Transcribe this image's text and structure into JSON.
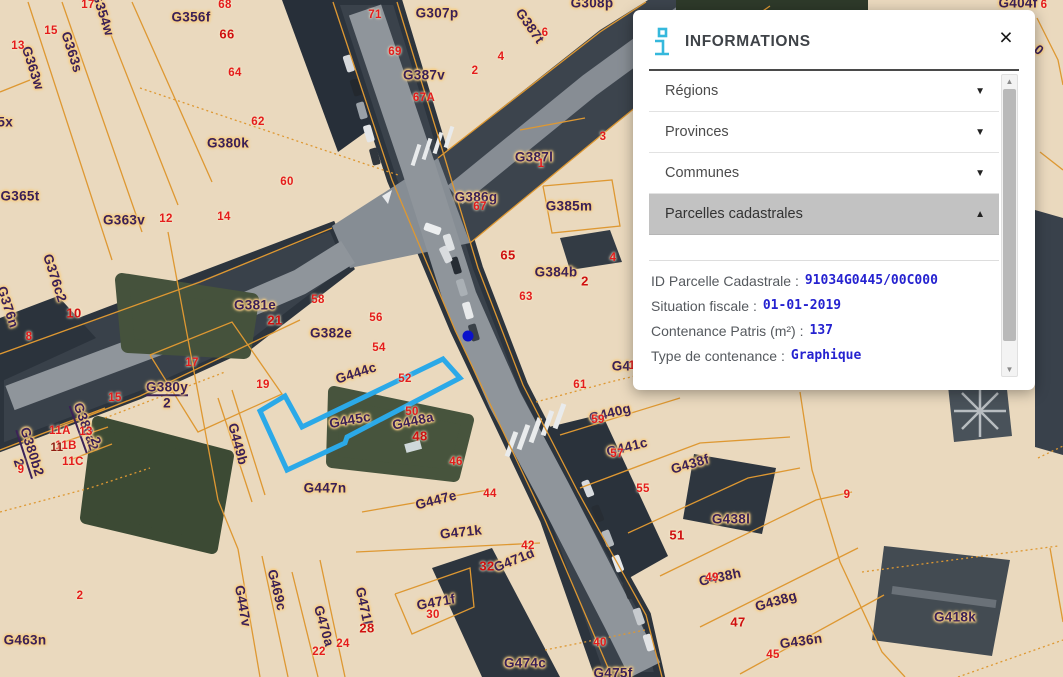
{
  "panel": {
    "title": "INFORMATIONS",
    "close_label": "×",
    "accordion": [
      {
        "label": "Régions",
        "state": "collapsed",
        "chevron": "▼"
      },
      {
        "label": "Provinces",
        "state": "collapsed",
        "chevron": "▼"
      },
      {
        "label": "Communes",
        "state": "collapsed",
        "chevron": "▼"
      },
      {
        "label": "Parcelles cadastrales",
        "state": "expanded",
        "chevron": "▲"
      }
    ],
    "details": [
      {
        "label": "ID Parcelle Cadastrale :",
        "value": "91034G0445/00C000"
      },
      {
        "label": "Situation fiscale :",
        "value": "01-01-2019"
      },
      {
        "label": "Contenance Patris (m²) :",
        "value": "137"
      },
      {
        "label": "Type de contenance :",
        "value": "Graphique"
      }
    ],
    "scrollbar": {
      "up_arrow": "▲",
      "down_arrow": "▼"
    }
  },
  "map": {
    "highlight_color": "#2BA9E8",
    "marker_color": "#0B12CC",
    "parcel_line_color": "#DE9832",
    "parcel_label_color": "#3A2057",
    "house_number_color": "#E41C1C",
    "selected_parcel_id": "91034G0445/00C000",
    "parcel_labels": [
      {
        "t": "G354w",
        "x": 103,
        "y": 14,
        "r": 72
      },
      {
        "t": "G356f",
        "x": 191,
        "y": 17,
        "r": 0
      },
      {
        "t": "G307p",
        "x": 437,
        "y": 13,
        "r": 0
      },
      {
        "t": "G308p",
        "x": 592,
        "y": 3,
        "r": 0
      },
      {
        "t": "G387t",
        "x": 530,
        "y": 26,
        "r": 55
      },
      {
        "t": "G387v",
        "x": 424,
        "y": 75,
        "r": 0
      },
      {
        "t": "G387l",
        "x": 534,
        "y": 157,
        "r": 0
      },
      {
        "t": "G386g",
        "x": 476,
        "y": 197,
        "r": 0
      },
      {
        "t": "G385m",
        "x": 569,
        "y": 206,
        "r": 0
      },
      {
        "t": "G384b",
        "x": 556,
        "y": 272,
        "r": 0
      },
      {
        "t": "G363w",
        "x": 33,
        "y": 68,
        "r": 72
      },
      {
        "t": "G363s",
        "x": 72,
        "y": 52,
        "r": 72
      },
      {
        "t": "G365x",
        "x": -8,
        "y": 122,
        "r": 0
      },
      {
        "t": "G365t",
        "x": 20,
        "y": 196,
        "r": 0
      },
      {
        "t": "G380k",
        "x": 228,
        "y": 143,
        "r": 0
      },
      {
        "t": "G363v",
        "x": 124,
        "y": 220,
        "r": 0
      },
      {
        "t": "G376c2",
        "x": 55,
        "y": 278,
        "r": 72
      },
      {
        "t": "G376n",
        "x": 8,
        "y": 307,
        "r": 72
      },
      {
        "t": "G381e",
        "x": 255,
        "y": 305,
        "r": 0
      },
      {
        "t": "G382e",
        "x": 331,
        "y": 333,
        "r": 0
      },
      {
        "t": "G380y",
        "x": 167,
        "y": 388,
        "r": 0,
        "u": 1
      },
      {
        "t": "2",
        "x": 167,
        "y": 403,
        "r": 0
      },
      {
        "t": "G444c",
        "x": 356,
        "y": 373,
        "r": -18
      },
      {
        "t": "G445c",
        "x": 350,
        "y": 420,
        "r": -10
      },
      {
        "t": "G448a",
        "x": 413,
        "y": 421,
        "r": -12
      },
      {
        "t": "G449b",
        "x": 238,
        "y": 444,
        "r": 75
      },
      {
        "t": "G380a2",
        "x": 85,
        "y": 427,
        "r": 70,
        "u": 1
      },
      {
        "t": "2",
        "x": 96,
        "y": 441,
        "r": 70
      },
      {
        "t": "G380b2",
        "x": 31,
        "y": 452,
        "r": 72,
        "u": 1
      },
      {
        "t": "2",
        "x": 19,
        "y": 463,
        "r": 72
      },
      {
        "t": "G447n",
        "x": 325,
        "y": 488,
        "r": 0
      },
      {
        "t": "G447e",
        "x": 436,
        "y": 500,
        "r": -14
      },
      {
        "t": "G471k",
        "x": 461,
        "y": 532,
        "r": -6
      },
      {
        "t": "G471d",
        "x": 514,
        "y": 560,
        "r": -22
      },
      {
        "t": "G471f",
        "x": 436,
        "y": 602,
        "r": -10
      },
      {
        "t": "G471l",
        "x": 364,
        "y": 606,
        "r": 78
      },
      {
        "t": "G470a",
        "x": 324,
        "y": 626,
        "r": 74
      },
      {
        "t": "G469c",
        "x": 277,
        "y": 590,
        "r": 76
      },
      {
        "t": "G447v",
        "x": 243,
        "y": 606,
        "r": 80
      },
      {
        "t": "G463n",
        "x": 25,
        "y": 640,
        "r": 0
      },
      {
        "t": "G474c",
        "x": 525,
        "y": 663,
        "r": 0
      },
      {
        "t": "G475f",
        "x": 613,
        "y": 673,
        "r": 0
      },
      {
        "t": "G438f",
        "x": 690,
        "y": 464,
        "r": -16
      },
      {
        "t": "G438l",
        "x": 731,
        "y": 519,
        "r": 0
      },
      {
        "t": "G440g",
        "x": 610,
        "y": 413,
        "r": -14
      },
      {
        "t": "G441c",
        "x": 627,
        "y": 447,
        "r": -14
      },
      {
        "t": "G438h",
        "x": 720,
        "y": 577,
        "r": -12
      },
      {
        "t": "G438g",
        "x": 776,
        "y": 601,
        "r": -16
      },
      {
        "t": "G436n",
        "x": 801,
        "y": 641,
        "r": -8
      },
      {
        "t": "G418k",
        "x": 955,
        "y": 617,
        "r": 0
      },
      {
        "t": "G404f",
        "x": 1018,
        "y": 3,
        "r": 0
      },
      {
        "t": "G4",
        "x": 621,
        "y": 366,
        "r": 0
      },
      {
        "t": "0",
        "x": 1039,
        "y": 50,
        "r": 40
      }
    ],
    "house_numbers": [
      {
        "t": "17",
        "x": 88,
        "y": 5
      },
      {
        "t": "15",
        "x": 51,
        "y": 31
      },
      {
        "t": "13",
        "x": 18,
        "y": 46
      },
      {
        "t": "68",
        "x": 225,
        "y": 5
      },
      {
        "t": "66",
        "x": 227,
        "y": 34,
        "b": 1
      },
      {
        "t": "64",
        "x": 235,
        "y": 73
      },
      {
        "t": "62",
        "x": 258,
        "y": 122
      },
      {
        "t": "60",
        "x": 287,
        "y": 182
      },
      {
        "t": "71",
        "x": 375,
        "y": 15
      },
      {
        "t": "69",
        "x": 395,
        "y": 52
      },
      {
        "t": "4",
        "x": 501,
        "y": 57
      },
      {
        "t": "2",
        "x": 475,
        "y": 71
      },
      {
        "t": "67A",
        "x": 424,
        "y": 98
      },
      {
        "t": "6",
        "x": 545,
        "y": 33
      },
      {
        "t": "1",
        "x": 541,
        "y": 164
      },
      {
        "t": "67",
        "x": 480,
        "y": 207
      },
      {
        "t": "3",
        "x": 603,
        "y": 137
      },
      {
        "t": "65",
        "x": 508,
        "y": 255,
        "b": 1
      },
      {
        "t": "4",
        "x": 613,
        "y": 258
      },
      {
        "t": "2",
        "x": 585,
        "y": 281,
        "b": 1
      },
      {
        "t": "63",
        "x": 526,
        "y": 297
      },
      {
        "t": "12",
        "x": 166,
        "y": 219
      },
      {
        "t": "14",
        "x": 224,
        "y": 217
      },
      {
        "t": "10",
        "x": 74,
        "y": 313,
        "b": 1
      },
      {
        "t": "8",
        "x": 29,
        "y": 337
      },
      {
        "t": "21",
        "x": 275,
        "y": 320,
        "b": 1
      },
      {
        "t": "58",
        "x": 318,
        "y": 300
      },
      {
        "t": "56",
        "x": 376,
        "y": 318
      },
      {
        "t": "54",
        "x": 379,
        "y": 348
      },
      {
        "t": "52",
        "x": 405,
        "y": 379
      },
      {
        "t": "50",
        "x": 412,
        "y": 412
      },
      {
        "t": "48",
        "x": 420,
        "y": 436,
        "b": 1
      },
      {
        "t": "46",
        "x": 456,
        "y": 462
      },
      {
        "t": "44",
        "x": 490,
        "y": 494
      },
      {
        "t": "42",
        "x": 528,
        "y": 546
      },
      {
        "t": "17",
        "x": 192,
        "y": 363
      },
      {
        "t": "19",
        "x": 263,
        "y": 385
      },
      {
        "t": "15",
        "x": 115,
        "y": 398
      },
      {
        "t": "11A",
        "x": 60,
        "y": 431
      },
      {
        "t": "13",
        "x": 86,
        "y": 432
      },
      {
        "t": "11B",
        "x": 66,
        "y": 446
      },
      {
        "t": "11",
        "x": 57,
        "y": 448,
        "dk": 1
      },
      {
        "t": "11C",
        "x": 73,
        "y": 462
      },
      {
        "t": "9",
        "x": 21,
        "y": 470
      },
      {
        "t": "2",
        "x": 80,
        "y": 596
      },
      {
        "t": "61",
        "x": 580,
        "y": 385
      },
      {
        "t": "1",
        "x": 632,
        "y": 366
      },
      {
        "t": "59",
        "x": 598,
        "y": 420
      },
      {
        "t": "57",
        "x": 617,
        "y": 454
      },
      {
        "t": "55",
        "x": 643,
        "y": 489
      },
      {
        "t": "51",
        "x": 677,
        "y": 535,
        "b": 1
      },
      {
        "t": "49",
        "x": 712,
        "y": 578
      },
      {
        "t": "47",
        "x": 738,
        "y": 622,
        "b": 1
      },
      {
        "t": "45",
        "x": 773,
        "y": 655
      },
      {
        "t": "40",
        "x": 600,
        "y": 643
      },
      {
        "t": "9",
        "x": 847,
        "y": 495
      },
      {
        "t": "32",
        "x": 487,
        "y": 566,
        "b": 1
      },
      {
        "t": "30",
        "x": 433,
        "y": 615
      },
      {
        "t": "28",
        "x": 367,
        "y": 628,
        "b": 1
      },
      {
        "t": "24",
        "x": 343,
        "y": 644
      },
      {
        "t": "22",
        "x": 319,
        "y": 652
      },
      {
        "t": "6",
        "x": 1044,
        "y": 5
      }
    ]
  }
}
